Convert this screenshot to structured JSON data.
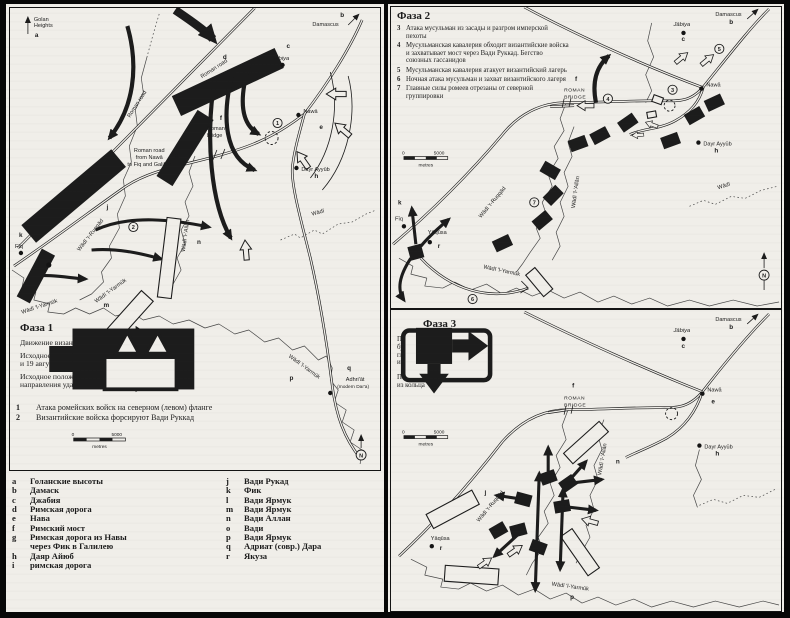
{
  "colors": {
    "paper": "#f0eee9",
    "ink": "#1c1c1c",
    "page_bg": "#070707"
  },
  "en": {
    "golan1": "Golan",
    "golan2": "Heights",
    "damascus": "Damascus",
    "jabiya": "Jābiya",
    "nawa": "Nawā",
    "dayr_ayyub": "Dayr Ayyūb",
    "roman_road": "Roman road",
    "roman_bridge1": "Roman",
    "roman_bridge2": "bridge",
    "roman_caps1": "ROMAN",
    "roman_caps2": "BRIDGE",
    "road_g1": "Roman road",
    "road_g2": "from Nawā",
    "road_g3": "to Fiq and Galilee",
    "ruqqad": "Wādī 'r-Ruqqād",
    "fiq": "Fīq",
    "yarmuk": "Wādī 'l-Yarmūk",
    "allan": "Wādī 'l-'Allān",
    "wadi": "Wādī",
    "adhriat1": "Adhri'āt",
    "adhriat2": "(modern Dar'a)",
    "yaqusa": "Yāqūsa",
    "north": "N",
    "scale_zero": "0",
    "scale_max": "5000",
    "scale_unit": "metres",
    "keys": {
      "a": "a",
      "b": "b",
      "c": "c",
      "d": "d",
      "e": "e",
      "f": "f",
      "g": "g",
      "h": "h",
      "i": "i",
      "j": "j",
      "k": "k",
      "l": "l",
      "m": "m",
      "n": "n",
      "o": "o",
      "p": "p",
      "q": "q",
      "r": "r"
    },
    "nums": {
      "n1": "1",
      "n2": "2",
      "n3": "3",
      "n4": "4",
      "n5": "5",
      "n6": "6",
      "n7": "7"
    }
  },
  "phase1": {
    "title": "Фаза 1",
    "legend": [
      {
        "icon": "black-arrow",
        "text": "Движение византийских войск"
      },
      {
        "icon": "black-bar",
        "text": "Исходное положение (возможно) имперских войск 18 и 19 августа"
      },
      {
        "icon": "outline-camp-arrows",
        "text": "Исходное положение (возможно) исламских войск и направления ударов"
      }
    ],
    "notes": [
      {
        "num": "1",
        "text": "Атака ромейских войск на северном (левом) фланге"
      },
      {
        "num": "2",
        "text": "Византийские войска форсируют Вади Руккад"
      }
    ]
  },
  "phase2": {
    "title": "Фаза 2",
    "notes": [
      {
        "num": "3",
        "text": "Атака мусульман из засады и разгром имперской пехоты"
      },
      {
        "num": "4",
        "text": "Мусульманская кавалерия обходит византийские войска и захватывает мост через Вади Руккад. Бегство союзных гассанидов"
      },
      {
        "num": "5",
        "text": "Мусульманская кавалерия атакует византийский лагерь"
      },
      {
        "num": "6",
        "text": "Ночная атака мусульман и захват византийского лагеря"
      },
      {
        "num": "7",
        "text": "Главные силы ромеев отрезаны от северной группировки"
      }
    ]
  },
  "phase3": {
    "title": "Фаза 3",
    "legend": [
      {
        "icon": "outline-rect",
        "text": "Под прикрытием пыльной бури мусульмане окружают главные силы ромеев (центр и правый фланг)"
      },
      {
        "icon": "black-square-breakout",
        "text": "Попытки ромеев вырваться из кольца"
      }
    ]
  },
  "index": {
    "col1": [
      {
        "key": "a",
        "text": "Голанские высоты"
      },
      {
        "key": "b",
        "text": "Дамаск"
      },
      {
        "key": "c",
        "text": "Джабия"
      },
      {
        "key": "d",
        "text": "Римская дорога"
      },
      {
        "key": "e",
        "text": "Нава"
      },
      {
        "key": "f",
        "text": "Римский мост"
      },
      {
        "key": "g",
        "text": "Римская дорога из Навы через Фик в Галилею"
      },
      {
        "key": "h",
        "text": "Даяр Айюб"
      },
      {
        "key": "i",
        "text": "римская дорога"
      }
    ],
    "col2": [
      {
        "key": "j",
        "text": "Вади Рукад"
      },
      {
        "key": "k",
        "text": "Фик"
      },
      {
        "key": "l",
        "text": "Вади Ярмук"
      },
      {
        "key": "m",
        "text": "Вади Ярмук"
      },
      {
        "key": "n",
        "text": "Вади Аллан"
      },
      {
        "key": "o",
        "text": "Вади"
      },
      {
        "key": "p",
        "text": "Вади Ярмук"
      },
      {
        "key": "q",
        "text": "Адриат (совр.) Дара"
      },
      {
        "key": "r",
        "text": "Якуза"
      }
    ]
  }
}
